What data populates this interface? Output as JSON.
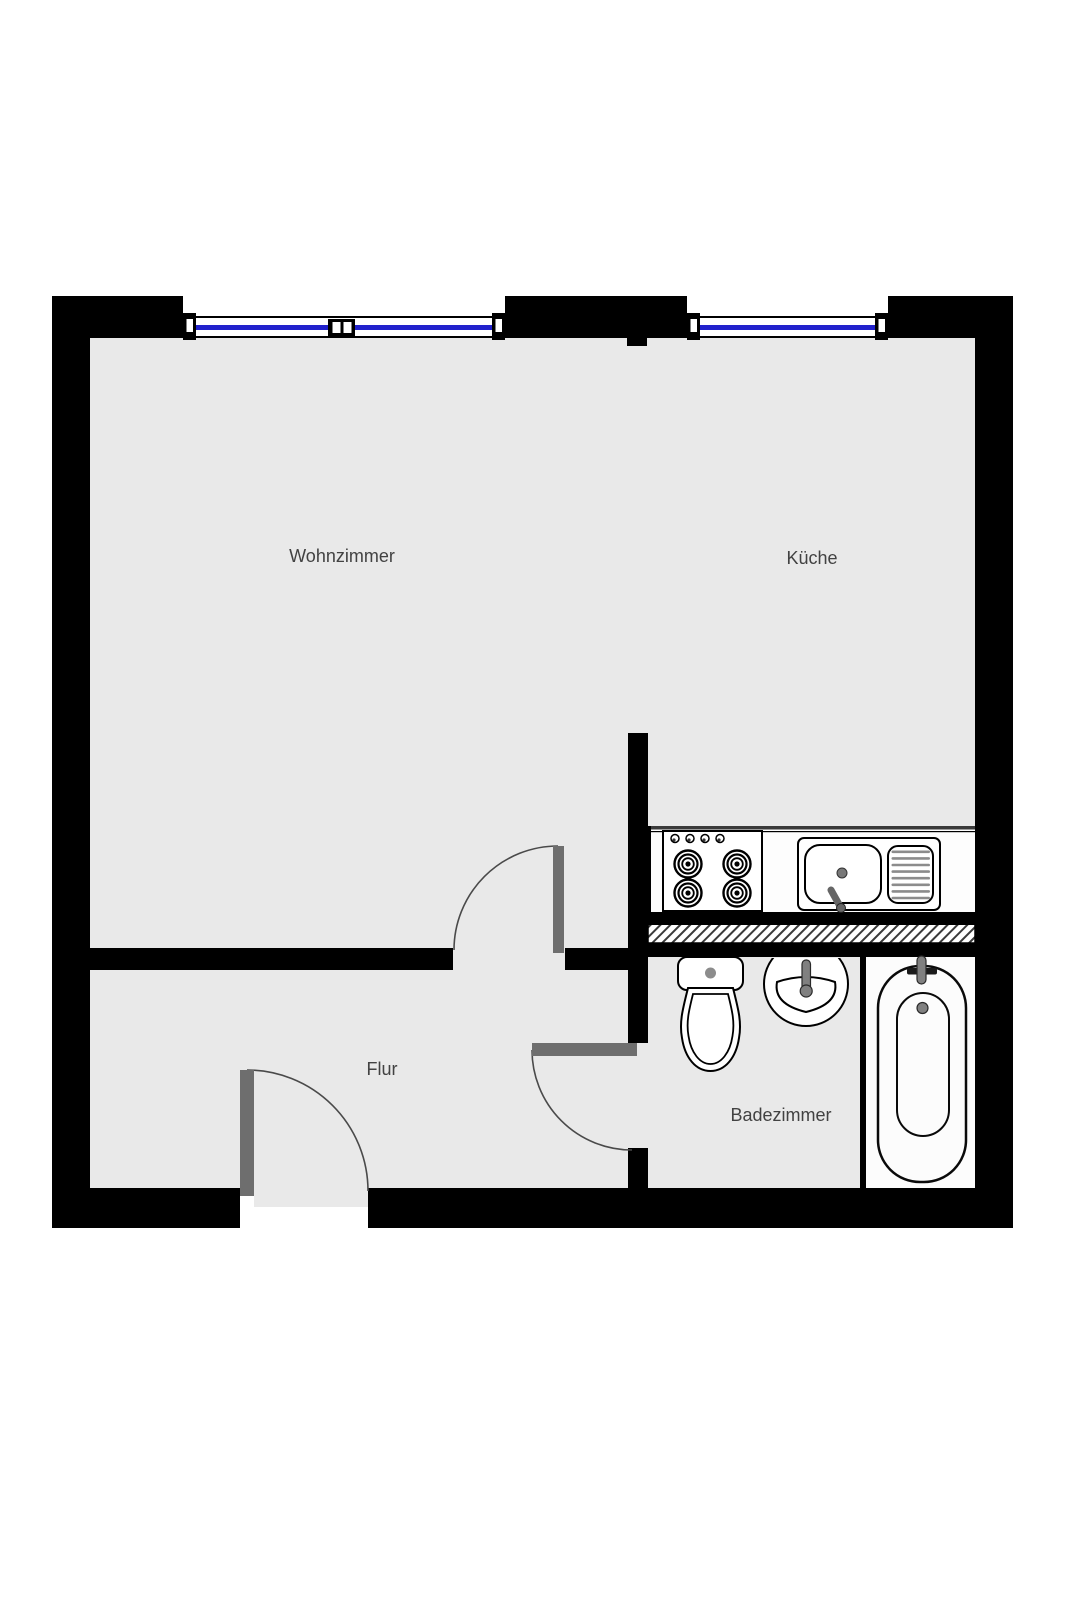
{
  "plan": {
    "rooms": [
      {
        "name": "wohnzimmer",
        "label": "Wohnzimmer"
      },
      {
        "name": "kueche",
        "label": "Küche"
      },
      {
        "name": "flur",
        "label": "Flur"
      },
      {
        "name": "badezimmer",
        "label": "Badezimmer"
      }
    ],
    "fixtures": [
      {
        "icon": "stove-icon"
      },
      {
        "icon": "kitchen-sink-icon"
      },
      {
        "icon": "toilet-icon"
      },
      {
        "icon": "washbasin-icon"
      },
      {
        "icon": "bathtub-icon"
      }
    ],
    "openings": {
      "windows": 2,
      "doors": 3
    },
    "colors": {
      "wall": "#000000",
      "floor": "#e9e9e9",
      "glass": "#2121cc",
      "door": "#6e6e6e",
      "label": "#424242",
      "hardware": "#808080",
      "fixture_fill": "#fdfdfd"
    }
  }
}
